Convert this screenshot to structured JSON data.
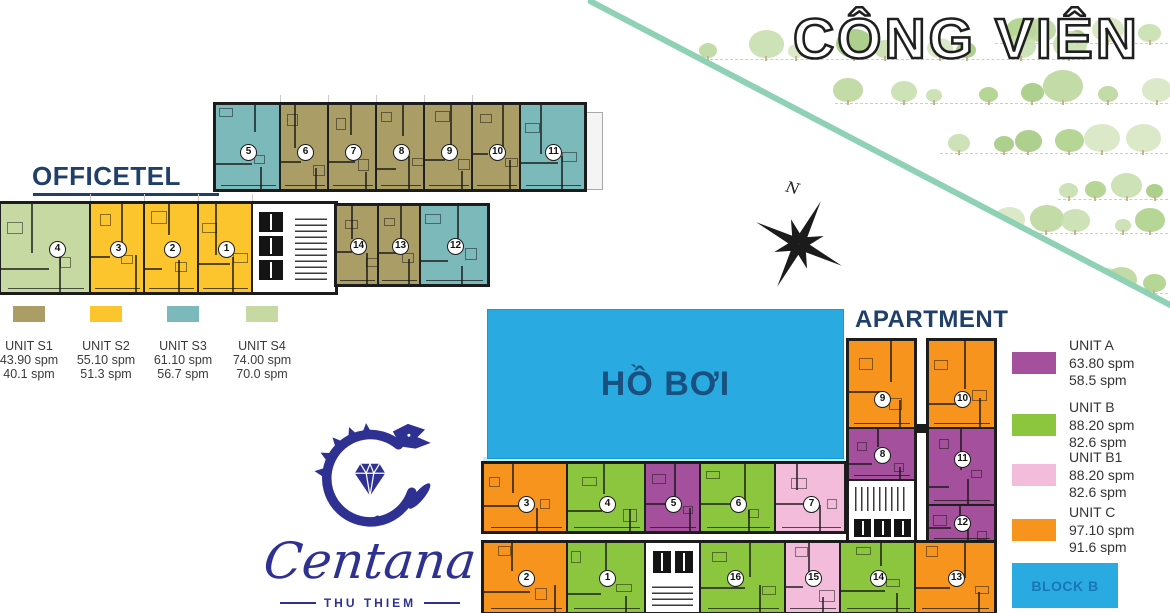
{
  "park": {
    "title": "CÔNG VIÊN"
  },
  "compass": {
    "label": "N"
  },
  "pool": {
    "label": "HỒ BƠI"
  },
  "block_badge": {
    "label": "BLOCK B"
  },
  "logo": {
    "name": "Centana",
    "subtitle": "THU THIEM"
  },
  "colors": {
    "pool_blue": "#29abe2",
    "badge_text": "#1b76b4",
    "heading_navy": "#20406b",
    "logo_blue": "#2e3192",
    "park_line": "#8ed1b5"
  },
  "officetel": {
    "title": "OFFICETEL",
    "legend": [
      {
        "name": "UNIT S1",
        "area1": "43.90 spm",
        "area2": "40.1 spm",
        "color": "#ab9d66"
      },
      {
        "name": "UNIT S2",
        "area1": "55.10 spm",
        "area2": "51.3 spm",
        "color": "#fcc42d"
      },
      {
        "name": "UNIT S3",
        "area1": "61.10 spm",
        "area2": "56.7 spm",
        "color": "#7cb9bb"
      },
      {
        "name": "UNIT S4",
        "area1": "74.00 spm",
        "area2": "70.0 spm",
        "color": "#c6d9a2"
      }
    ]
  },
  "apartment": {
    "title": "APARTMENT",
    "legend": [
      {
        "name": "UNIT A",
        "area1": "63.80 spm",
        "area2": "58.5 spm",
        "color": "#a4509c"
      },
      {
        "name": "UNIT B",
        "area1": "88.20 spm",
        "area2": "82.6 spm",
        "color": "#8cc63f"
      },
      {
        "name": "UNIT B1",
        "area1": "88.20 spm",
        "area2": "82.6 spm",
        "color": "#f3bcdb"
      },
      {
        "name": "UNIT C",
        "area1": "97.10 spm",
        "area2": "91.6 spm",
        "color": "#f7941e"
      }
    ]
  },
  "map": {
    "unit_colors": {
      "S1": "#ab9d66",
      "S2": "#fcc42d",
      "S3": "#7cb9bb",
      "S4": "#c6d9a2",
      "A": "#a4509c",
      "B": "#8cc63f",
      "B1": "#f3bcdb",
      "C": "#f7941e"
    },
    "buildings": [
      {
        "id": "officetel-row-a",
        "dir": "h",
        "x": 215,
        "y": 104,
        "h": 86,
        "units": [
          {
            "n": 5,
            "t": "S3",
            "len": 65,
            "ny": 4
          },
          {
            "n": 6,
            "t": "S1",
            "len": 48,
            "ny": 4
          },
          {
            "n": 7,
            "t": "S1",
            "len": 48,
            "ny": 4
          },
          {
            "n": 8,
            "t": "S1",
            "len": 48,
            "ny": 4
          },
          {
            "n": 9,
            "t": "S1",
            "len": 48,
            "ny": 4
          },
          {
            "n": 10,
            "t": "S1",
            "len": 48,
            "ny": 4
          },
          {
            "n": 11,
            "t": "S3",
            "len": 65,
            "ny": 4
          }
        ]
      },
      {
        "id": "officetel-row-b",
        "dir": "h",
        "x": 0,
        "y": 203,
        "h": 90,
        "units": [
          {
            "n": 4,
            "t": "S4",
            "len": 90,
            "nx": 11
          },
          {
            "n": 3,
            "t": "S2",
            "len": 54
          },
          {
            "n": 2,
            "t": "S2",
            "len": 54
          },
          {
            "n": 1,
            "t": "S2",
            "len": 54
          },
          {
            "core": true,
            "len": 84
          }
        ]
      },
      {
        "id": "officetel-row-c",
        "dir": "h",
        "x": 336,
        "y": 205,
        "h": 80,
        "units": [
          {
            "n": 14,
            "t": "S1",
            "len": 42
          },
          {
            "n": 13,
            "t": "S1",
            "len": 42
          },
          {
            "n": 12,
            "t": "S3",
            "len": 68
          }
        ]
      },
      {
        "id": "apartment-wing-left",
        "dir": "v",
        "x": 848,
        "y": 340,
        "w": 67,
        "units": [
          {
            "n": 9,
            "t": "C",
            "len": 88,
            "ny": 14
          },
          {
            "n": 8,
            "t": "A",
            "len": 52
          },
          {
            "core": true,
            "len": 63
          }
        ]
      },
      {
        "id": "apartment-wing-right",
        "dir": "v",
        "x": 928,
        "y": 340,
        "w": 67,
        "units": [
          {
            "n": 10,
            "t": "C",
            "len": 88,
            "ny": 14
          },
          {
            "n": 11,
            "t": "A",
            "len": 77,
            "ny": -8
          },
          {
            "n": 12,
            "t": "A",
            "len": 38,
            "ny": -2
          }
        ]
      },
      {
        "id": "apartment-row-top",
        "dir": "h",
        "x": 483,
        "y": 463,
        "h": 69,
        "units": [
          {
            "n": 3,
            "t": "C",
            "len": 84,
            "ny": 6
          },
          {
            "n": 4,
            "t": "B",
            "len": 78,
            "ny": 6
          },
          {
            "n": 5,
            "t": "A",
            "len": 55,
            "ny": 6
          },
          {
            "n": 6,
            "t": "B",
            "len": 75,
            "ny": 6
          },
          {
            "n": 7,
            "t": "B1",
            "len": 70,
            "ny": 6
          }
        ]
      },
      {
        "id": "apartment-row-bottom",
        "dir": "h",
        "x": 483,
        "y": 542,
        "h": 71,
        "units": [
          {
            "n": 2,
            "t": "C",
            "len": 84
          },
          {
            "n": 1,
            "t": "B",
            "len": 78
          },
          {
            "core": true,
            "len": 55
          },
          {
            "n": 16,
            "t": "B",
            "len": 85,
            "nx": -8
          },
          {
            "n": 15,
            "t": "B1",
            "len": 55
          },
          {
            "n": 14,
            "t": "B",
            "len": 75
          },
          {
            "n": 13,
            "t": "C",
            "len": 80
          }
        ]
      }
    ]
  }
}
